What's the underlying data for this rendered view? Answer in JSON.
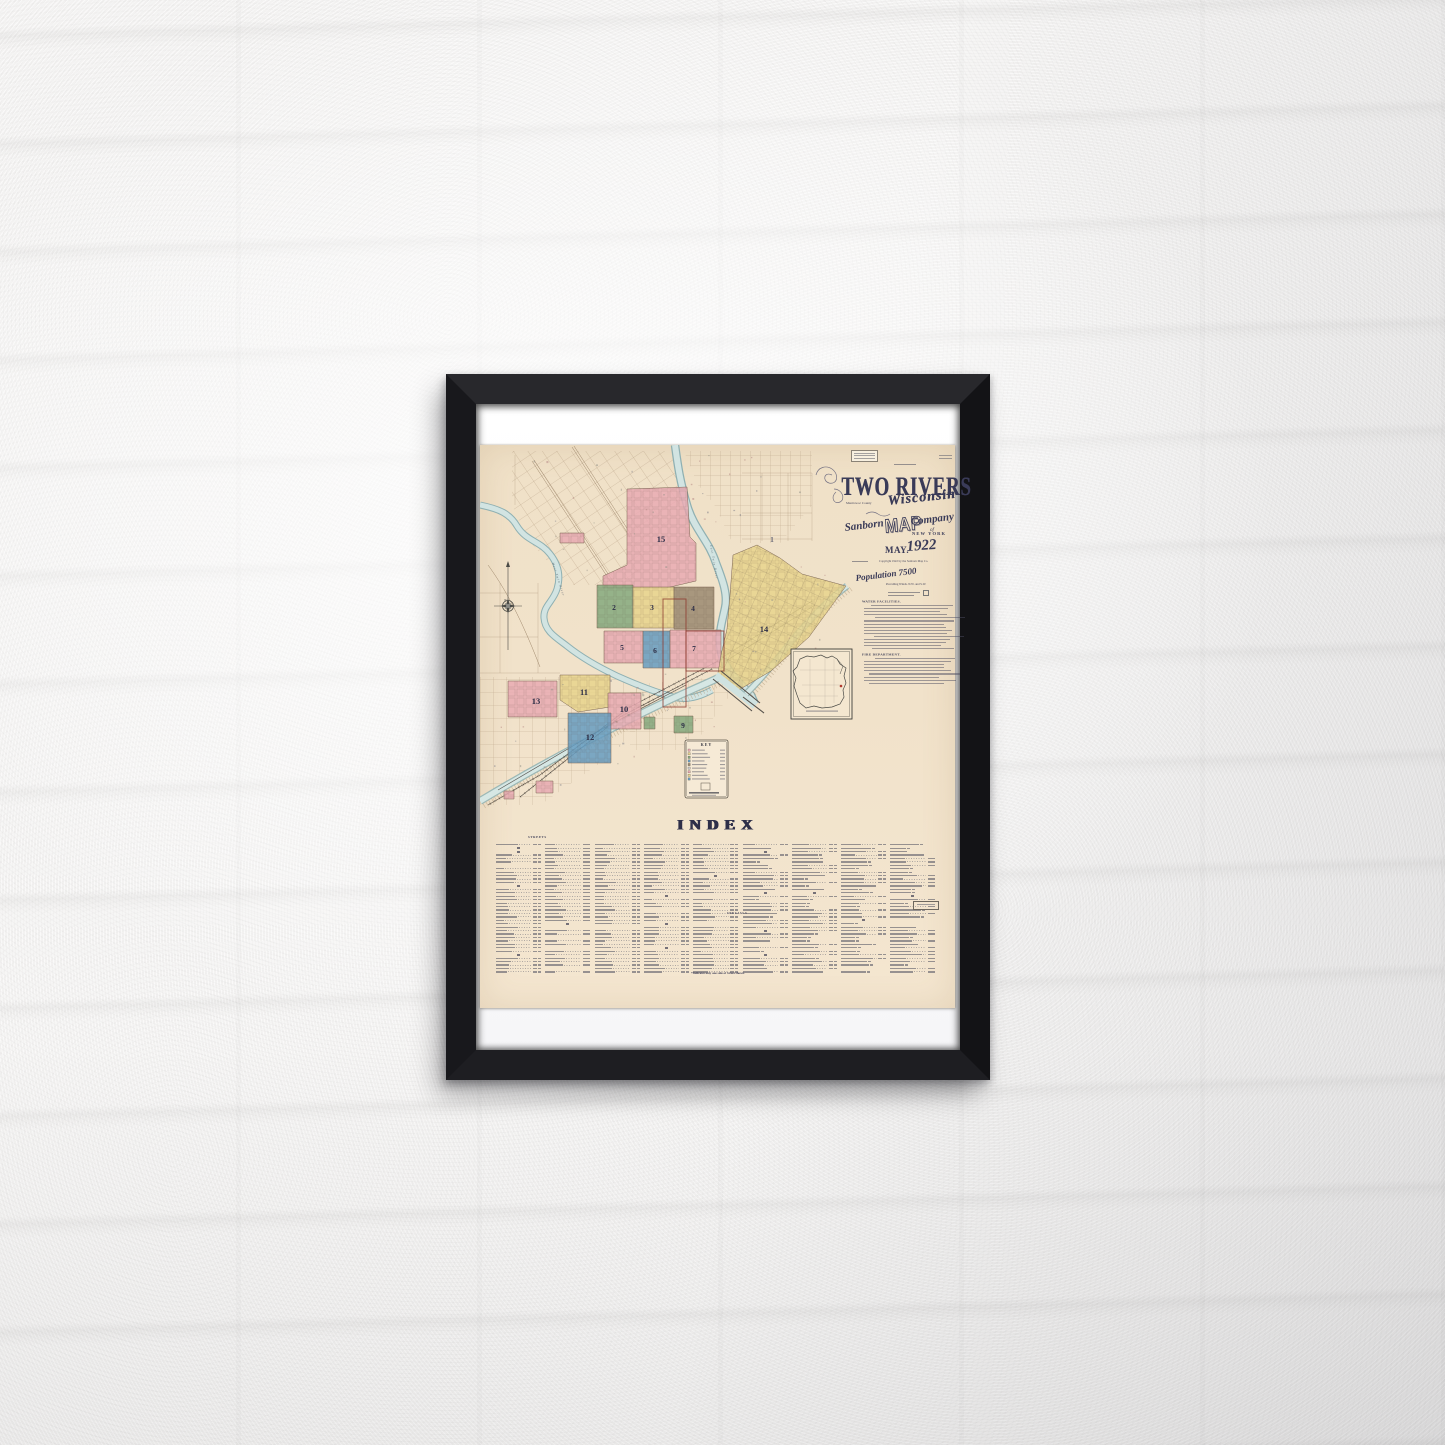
{
  "poster": {
    "title_block": {
      "city": "TWO RIVERS",
      "county": "Manitowoc County",
      "state": "Wisconsin",
      "publisher_word1": "Sanborn",
      "publisher_word2": "MAP",
      "publisher_word3": "Company",
      "publisher_of": "of",
      "publisher_city": "NEW YORK",
      "date_month": "MAY.",
      "date_year": "1922",
      "copyright": "Copyright 1922 by the Sanborn Map Co.",
      "population": "Population 7500",
      "winds": "Prevailing Winds. N.W. and S.W.",
      "water_heading": "WATER FACILITIES.",
      "fire_heading": "FIRE DEPARTMENT."
    },
    "map": {
      "compass_label": "N",
      "key_title": "KEY",
      "river_labels": [
        "West Twin River",
        "East Twin River"
      ],
      "districts": [
        {
          "number": "15",
          "color": "pink",
          "points": "147,44 207,42 210,92 216,98 216,136 186,143 123,143 123,131 147,120",
          "label": [
            181,
            97
          ]
        },
        {
          "number": "1",
          "color": "none",
          "points": "",
          "label": [
            292,
            97
          ]
        },
        {
          "number": "2",
          "color": "green",
          "points": "117,140 153,140 153,183 117,183",
          "label": [
            134,
            165
          ]
        },
        {
          "number": "3",
          "color": "yellow",
          "points": "153,142 194,142 194,183 153,183",
          "label": [
            172,
            165
          ]
        },
        {
          "number": "4",
          "color": "brown",
          "points": "194,142 234,142 234,184 194,184",
          "label": [
            213,
            166
          ]
        },
        {
          "number": "5",
          "color": "pink",
          "points": "124,186 163,186 163,218 124,218",
          "label": [
            142,
            205
          ]
        },
        {
          "number": "6",
          "color": "blue",
          "points": "163,186 190,186 190,223 163,223",
          "label": [
            175,
            208
          ]
        },
        {
          "number": "7",
          "color": "pink",
          "points": "190,185 241,185 241,223 190,223",
          "label": [
            214,
            206
          ]
        },
        {
          "number": "14",
          "color": "yellow",
          "points": "253,110 277,100 300,113 322,129 366,141 329,192 291,226 257,246 238,228 241,210 247,184 250,150",
          "label": [
            284,
            187
          ]
        },
        {
          "number": "11",
          "color": "yellow",
          "points": "80,230 130,230 130,262 98,267 80,255",
          "label": [
            104,
            250
          ]
        },
        {
          "number": "13",
          "color": "pink",
          "points": "28,236 77,236 77,272 28,272",
          "label": [
            56,
            259
          ]
        },
        {
          "number": "10",
          "color": "pink",
          "points": "128,248 161,248 161,284 128,284",
          "label": [
            144,
            267
          ]
        },
        {
          "number": "12",
          "color": "blue",
          "points": "88,268 131,268 131,318 88,318",
          "label": [
            110,
            295
          ]
        },
        {
          "number": "9",
          "color": "green",
          "points": "194,271 213,271 213,288 194,288",
          "label": [
            203,
            283
          ]
        }
      ],
      "patches": [
        {
          "color": "pink",
          "points": "80,88 104,88 104,98 80,98"
        },
        {
          "color": "pink",
          "points": "56,336 73,336 73,348 56,348"
        },
        {
          "color": "pink",
          "points": "24,346 34,346 34,354 24,354"
        },
        {
          "color": "green",
          "points": "164,272 175,272 175,284 164,284"
        }
      ]
    },
    "index": {
      "title": "INDEX",
      "streets_label": "STREETS",
      "specials_label": "SPECIALS",
      "footnote": "*Indicates only one side of Street shown.",
      "columns": 9,
      "rows_per_column": 38
    },
    "palette": {
      "pink": "#e9aab3",
      "yellow": "#e7d38c",
      "green": "#85a97e",
      "blue": "#669cc1",
      "brown": "#9b8a71",
      "river": "#d2e4e2",
      "river_edge": "#8fb0b2",
      "ink": "#3a3b58",
      "paper": "#f1e2c9",
      "frame": "#1b1b1f"
    }
  }
}
